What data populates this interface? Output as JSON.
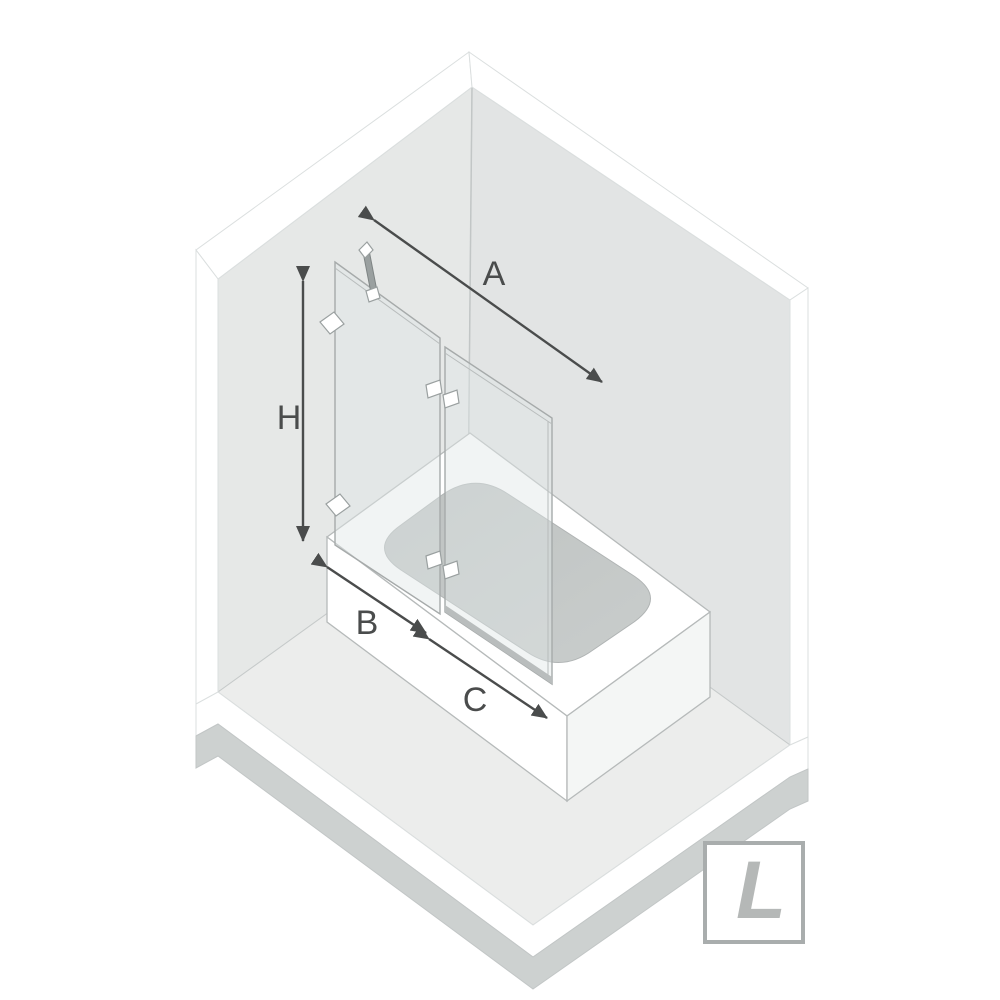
{
  "diagram": {
    "subject": "Bathtub with two-panel hinged bath screen in a room corner, isometric product diagram",
    "labels": {
      "width": "A",
      "height": "H",
      "fixed_panel": "B",
      "door_panel": "C"
    },
    "badge": {
      "letter": "L"
    }
  },
  "colors": {
    "background": "#ffffff",
    "wall_left": "#e6e8e7",
    "wall_right": "#e2e4e4",
    "floor": "#ecedec",
    "slab_side": "#cdd1d0",
    "bevel_white": "#ffffff",
    "tub_white": "#ffffff",
    "tub_side": "#f4f6f5",
    "basin": "#c3c7c6",
    "glass": "#dfe7e6",
    "glass_edge": "#a6aaaa",
    "hardware": "#9aa0a0",
    "outline": "#c6caca",
    "arrow": "#4a4c4c",
    "badge_border": "#a9adad",
    "badge_letter": "#b5b8b7"
  }
}
